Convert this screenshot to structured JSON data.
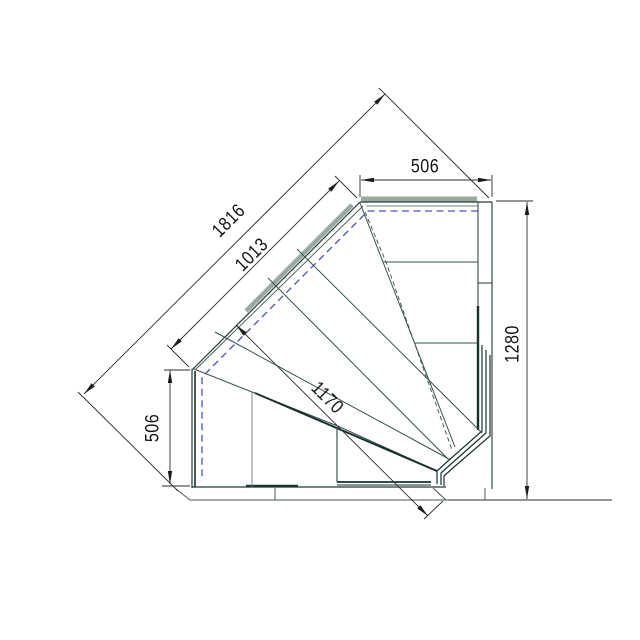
{
  "page": {
    "background": "#ffffff"
  },
  "drawing": {
    "type": "technical-plan",
    "subject": "internal corner display counter 90deg - top view",
    "units": "mm",
    "colors": {
      "outline": "#243937",
      "glass_band": "#9aa99e",
      "dark_band": "#16302e",
      "hidden_dashed": "#4450c4",
      "dimension_line": "#2b2b2b",
      "text": "#141414"
    },
    "dimensions": [
      {
        "id": "top-end-width",
        "value": "506",
        "orientation": "horizontal"
      },
      {
        "id": "right-side-depth",
        "value": "1280",
        "orientation": "vertical"
      },
      {
        "id": "overall-diagonal",
        "value": "1816",
        "orientation": "diagonal-45"
      },
      {
        "id": "front-glass-diagonal",
        "value": "1013",
        "orientation": "diagonal-45"
      },
      {
        "id": "corner-depth",
        "value": "1170",
        "orientation": "diagonal-45"
      },
      {
        "id": "left-end-width",
        "value": "506",
        "orientation": "vertical"
      }
    ]
  }
}
